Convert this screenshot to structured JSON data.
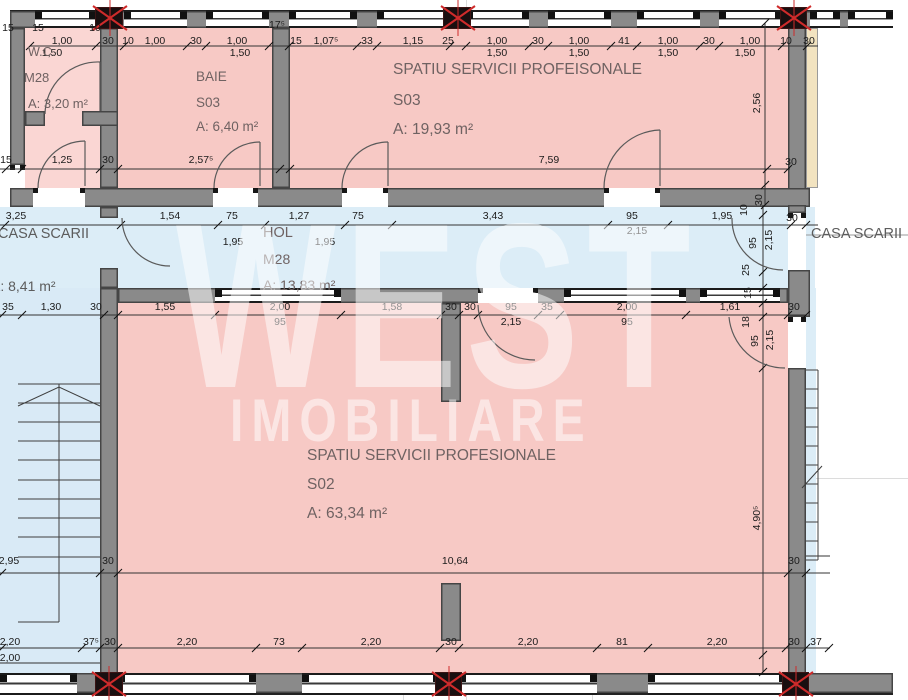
{
  "colors": {
    "room_pink": "#f7c9c5",
    "wc_pink": "#fad6d3",
    "hall_blue": "#dcedf7",
    "stair_blue": "#d9eaf6",
    "wall_gray": "#8a8a8a",
    "cream": "#f2e3c0",
    "marker_red": "#cf2b2b",
    "dim_text": "#1b1b1b",
    "label_text": "#6f6262"
  },
  "watermark": {
    "line1": "WEST",
    "line2": "IMOBILIARE"
  },
  "rooms": {
    "wc": {
      "name": "W.C.",
      "code": "M28",
      "area": "A: 3,20 m²"
    },
    "baie": {
      "name": "BAIE",
      "code": "S03",
      "area": "A: 6,40 m²"
    },
    "s03": {
      "name": "SPATIU SERVICII PROFEISONALE",
      "code": "S03",
      "area": "A: 19,93 m²"
    },
    "hol": {
      "name": "HOL",
      "code": "M28",
      "area": "A: 13,83 m²"
    },
    "casa_scarii_left": {
      "name": "CASA SCARII",
      "area": "A: 8,41 m²"
    },
    "casa_scarii_right": {
      "name": "CASA SCARII"
    },
    "s02": {
      "name": "SPATIU SERVICII PROFESIONALE",
      "code": "S02",
      "area": "A: 63,34 m²"
    }
  },
  "dim_labels": [
    {
      "t": "15",
      "x": 8,
      "y": 28
    },
    {
      "t": "15",
      "x": 38,
      "y": 28
    },
    {
      "t": "10",
      "x": 95,
      "y": 28
    },
    {
      "t": "17⁵",
      "x": 277,
      "y": 25
    },
    {
      "t": "1,00",
      "x": 62,
      "y": 41
    },
    {
      "t": "30",
      "x": 108,
      "y": 41
    },
    {
      "t": "10",
      "x": 128,
      "y": 41
    },
    {
      "t": "1,00",
      "x": 155,
      "y": 41
    },
    {
      "t": "30",
      "x": 196,
      "y": 41
    },
    {
      "t": "1,00",
      "x": 237,
      "y": 41
    },
    {
      "t": "15",
      "x": 296,
      "y": 41
    },
    {
      "t": "1,07⁵",
      "x": 326,
      "y": 41
    },
    {
      "t": "33",
      "x": 367,
      "y": 41
    },
    {
      "t": "1,15",
      "x": 413,
      "y": 41
    },
    {
      "t": "25",
      "x": 448,
      "y": 41
    },
    {
      "t": "1,00",
      "x": 497,
      "y": 41
    },
    {
      "t": "30",
      "x": 538,
      "y": 41
    },
    {
      "t": "1,00",
      "x": 579,
      "y": 41
    },
    {
      "t": "41",
      "x": 624,
      "y": 41
    },
    {
      "t": "1,00",
      "x": 668,
      "y": 41
    },
    {
      "t": "30",
      "x": 709,
      "y": 41
    },
    {
      "t": "1,00",
      "x": 750,
      "y": 41
    },
    {
      "t": "10",
      "x": 786,
      "y": 41
    },
    {
      "t": "30",
      "x": 809,
      "y": 41
    },
    {
      "t": "1,50",
      "x": 52,
      "y": 53
    },
    {
      "t": "1,50",
      "x": 240,
      "y": 53
    },
    {
      "t": "1,50",
      "x": 497,
      "y": 53
    },
    {
      "t": "1,50",
      "x": 579,
      "y": 53
    },
    {
      "t": "1,50",
      "x": 668,
      "y": 53
    },
    {
      "t": "1,50",
      "x": 745,
      "y": 53
    },
    {
      "t": "15",
      "x": 6,
      "y": 160
    },
    {
      "t": "1,25",
      "x": 62,
      "y": 160
    },
    {
      "t": "30",
      "x": 108,
      "y": 160
    },
    {
      "t": "2,57⁵",
      "x": 201,
      "y": 160
    },
    {
      "t": "7,59",
      "x": 549,
      "y": 160
    },
    {
      "t": "30",
      "x": 791,
      "y": 162
    },
    {
      "t": "2,56",
      "x": 757,
      "y": 103,
      "r": 1
    },
    {
      "t": "30",
      "x": 759,
      "y": 200,
      "r": 1
    },
    {
      "t": "10",
      "x": 744,
      "y": 210,
      "r": 1
    },
    {
      "t": "30",
      "x": 792,
      "y": 218
    },
    {
      "t": "3,25",
      "x": 16,
      "y": 216
    },
    {
      "t": "1,54",
      "x": 170,
      "y": 216
    },
    {
      "t": "75",
      "x": 232,
      "y": 216
    },
    {
      "t": "1,27",
      "x": 299,
      "y": 216
    },
    {
      "t": "75",
      "x": 358,
      "y": 216
    },
    {
      "t": "3,43",
      "x": 493,
      "y": 216
    },
    {
      "t": "95",
      "x": 632,
      "y": 216
    },
    {
      "t": "1,95",
      "x": 722,
      "y": 216
    },
    {
      "t": "1,95",
      "x": 233,
      "y": 242
    },
    {
      "t": "1,95",
      "x": 325,
      "y": 242
    },
    {
      "t": "2,15",
      "x": 637,
      "y": 231
    },
    {
      "t": "95",
      "x": 753,
      "y": 243,
      "r": 1
    },
    {
      "t": "2,15",
      "x": 769,
      "y": 240,
      "r": 1
    },
    {
      "t": "25",
      "x": 746,
      "y": 270,
      "r": 1
    },
    {
      "t": "15",
      "x": 748,
      "y": 293,
      "r": 1
    },
    {
      "t": "35",
      "x": 8,
      "y": 307
    },
    {
      "t": "1,30",
      "x": 51,
      "y": 307
    },
    {
      "t": "30",
      "x": 96,
      "y": 307
    },
    {
      "t": "1,55",
      "x": 165,
      "y": 307
    },
    {
      "t": "2,00",
      "x": 280,
      "y": 307
    },
    {
      "t": "1,58",
      "x": 392,
      "y": 307
    },
    {
      "t": "30",
      "x": 451,
      "y": 307
    },
    {
      "t": "30",
      "x": 470,
      "y": 307
    },
    {
      "t": "95",
      "x": 511,
      "y": 307
    },
    {
      "t": "35",
      "x": 547,
      "y": 307
    },
    {
      "t": "2,00",
      "x": 627,
      "y": 307
    },
    {
      "t": "1,61",
      "x": 730,
      "y": 307
    },
    {
      "t": "30",
      "x": 794,
      "y": 307
    },
    {
      "t": "95",
      "x": 280,
      "y": 322
    },
    {
      "t": "2,15",
      "x": 511,
      "y": 322
    },
    {
      "t": "95",
      "x": 627,
      "y": 322
    },
    {
      "t": "18",
      "x": 746,
      "y": 322,
      "r": 1
    },
    {
      "t": "95",
      "x": 755,
      "y": 341,
      "r": 1
    },
    {
      "t": "2,15",
      "x": 770,
      "y": 340,
      "r": 1
    },
    {
      "t": "4,90⁵",
      "x": 757,
      "y": 518,
      "r": 1
    },
    {
      "t": "2,95",
      "x": 9,
      "y": 561
    },
    {
      "t": "30",
      "x": 108,
      "y": 561
    },
    {
      "t": "10,64",
      "x": 455,
      "y": 561
    },
    {
      "t": "30",
      "x": 794,
      "y": 561
    },
    {
      "t": "2,20",
      "x": 10,
      "y": 642
    },
    {
      "t": "37⁵",
      "x": 91,
      "y": 642
    },
    {
      "t": "30",
      "x": 110,
      "y": 642
    },
    {
      "t": "2,20",
      "x": 187,
      "y": 642
    },
    {
      "t": "73",
      "x": 279,
      "y": 642
    },
    {
      "t": "2,20",
      "x": 371,
      "y": 642
    },
    {
      "t": "30",
      "x": 451,
      "y": 642
    },
    {
      "t": "2,20",
      "x": 528,
      "y": 642
    },
    {
      "t": "81",
      "x": 622,
      "y": 642
    },
    {
      "t": "2,20",
      "x": 717,
      "y": 642
    },
    {
      "t": "30",
      "x": 794,
      "y": 642
    },
    {
      "t": "37",
      "x": 816,
      "y": 642
    },
    {
      "t": "2,00",
      "x": 10,
      "y": 658
    }
  ]
}
